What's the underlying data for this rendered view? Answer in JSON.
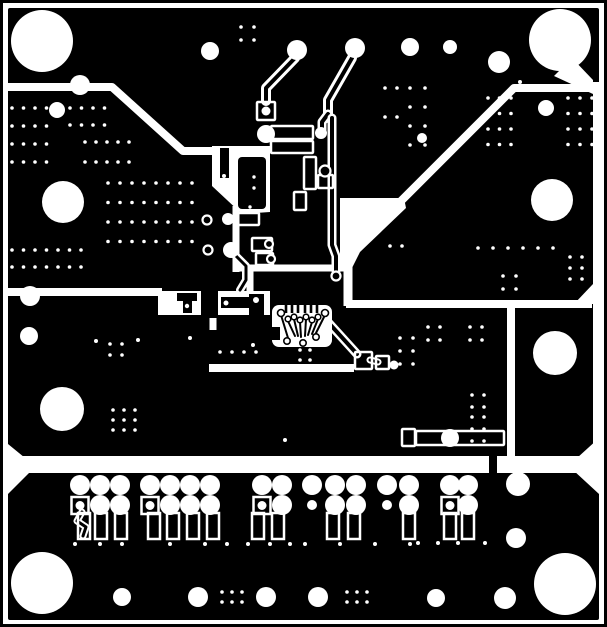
{
  "meta": {
    "title": "PCB copper layer artwork (negative, black = copper)",
    "width": 607,
    "height": 627,
    "colors": {
      "copper": "#000000",
      "clearance": "#ffffff"
    }
  },
  "pcb": {
    "board": [
      8,
      8,
      591,
      612
    ],
    "frame": {
      "inset": 1.5,
      "stroke": 3
    },
    "wpolys": [
      [
        [
          212,
          146
        ],
        [
          270,
          146
        ],
        [
          270,
          212
        ],
        [
          242,
          214
        ],
        [
          212,
          186
        ]
      ],
      [
        [
          340,
          198
        ],
        [
          404,
          198
        ],
        [
          406,
          208
        ],
        [
          360,
          252
        ],
        [
          352,
          268
        ],
        [
          340,
          268
        ]
      ],
      [
        [
          572,
          58
        ],
        [
          593,
          80
        ],
        [
          593,
          94
        ],
        [
          554,
          76
        ]
      ],
      [
        [
          8,
          444
        ],
        [
          30,
          462
        ],
        [
          8,
          462
        ]
      ],
      [
        [
          8,
          470
        ],
        [
          32,
          470
        ],
        [
          8,
          494
        ]
      ],
      [
        [
          599,
          470
        ],
        [
          573,
          470
        ],
        [
          599,
          494
        ]
      ],
      [
        [
          599,
          438
        ],
        [
          599,
          458
        ],
        [
          577,
          458
        ]
      ],
      [
        [
          593,
          284
        ],
        [
          593,
          304
        ],
        [
          574,
          304
        ]
      ]
    ],
    "wrects": [
      [
        593,
        82,
        8,
        380
      ],
      [
        8,
        456,
        591,
        17
      ],
      [
        158,
        291,
        112,
        24
      ]
    ],
    "channels": [
      {
        "pts": [
          [
            8,
            87
          ],
          [
            112,
            87
          ],
          [
            183,
            151
          ],
          [
            216,
            151
          ]
        ],
        "w": 8
      },
      {
        "pts": [
          [
            599,
            88
          ],
          [
            514,
            88
          ],
          [
            398,
            204
          ]
        ],
        "w": 8
      },
      {
        "pts": [
          [
            233,
            268
          ],
          [
            344,
            268
          ]
        ],
        "w": 7
      },
      {
        "pts": [
          [
            236,
            206
          ],
          [
            236,
            272
          ]
        ],
        "w": 7
      },
      {
        "pts": [
          [
            250,
            268
          ],
          [
            250,
            294
          ]
        ],
        "w": 7
      },
      {
        "pts": [
          [
            346,
            304
          ],
          [
            592,
            304
          ]
        ],
        "w": 8
      },
      {
        "pts": [
          [
            511,
            304
          ],
          [
            511,
            460
          ]
        ],
        "w": 8
      },
      {
        "pts": [
          [
            8,
            292
          ],
          [
            162,
            292
          ]
        ],
        "w": 8
      },
      {
        "pts": [
          [
            213,
            294
          ],
          [
            213,
            330
          ]
        ],
        "w": 7
      },
      {
        "pts": [
          [
            209,
            368
          ],
          [
            354,
            368
          ]
        ],
        "w": 8
      },
      {
        "pts": [
          [
            348,
            240
          ],
          [
            348,
            306
          ]
        ],
        "w": 9
      }
    ],
    "bislands": [
      [
        201,
        289,
        17,
        29
      ],
      [
        177,
        293,
        20,
        8
      ],
      [
        183,
        300,
        9,
        13
      ],
      [
        221,
        297,
        28,
        11
      ],
      [
        249,
        294,
        15,
        22
      ],
      [
        220,
        148,
        9,
        30
      ],
      [
        489,
        455,
        8,
        19
      ]
    ],
    "traces": [
      {
        "pts": [
          [
            295,
            58
          ],
          [
            266,
            88
          ],
          [
            266,
            101
          ]
        ],
        "out": 10,
        "core": 4
      },
      {
        "pts": [
          [
            352,
            58
          ],
          [
            328,
            100
          ],
          [
            328,
            118
          ]
        ],
        "out": 10,
        "core": 4
      },
      {
        "pts": [
          [
            328,
            114
          ],
          [
            322,
            122
          ],
          [
            322,
            130
          ]
        ],
        "out": 9,
        "core": 4
      },
      {
        "pts": [
          [
            332,
            118
          ],
          [
            332,
            245
          ],
          [
            336,
            256
          ],
          [
            336,
            271
          ]
        ],
        "out": 9,
        "core": 4
      },
      {
        "pts": [
          [
            234,
            254
          ],
          [
            246,
            266
          ],
          [
            246,
            280
          ],
          [
            240,
            290
          ]
        ],
        "out": 8,
        "core": 3
      },
      {
        "pts": [
          [
            327,
            321
          ],
          [
            357,
            354
          ]
        ],
        "out": 9,
        "core": 4
      },
      {
        "pts": [
          [
            370,
            360
          ],
          [
            378,
            362
          ]
        ],
        "out": 7,
        "core": 3
      },
      {
        "pts": [
          [
            82,
            512
          ],
          [
            77,
            521
          ],
          [
            86,
            527
          ],
          [
            83,
            536
          ]
        ],
        "out": 7,
        "core": 3
      }
    ],
    "boxes": [
      [
        257,
        102,
        18,
        18
      ],
      [
        271,
        126,
        42,
        13
      ],
      [
        271,
        141,
        42,
        12
      ],
      [
        237,
        213,
        22,
        12
      ],
      [
        252,
        238,
        20,
        13
      ],
      [
        256,
        253,
        17,
        12
      ],
      [
        416,
        431,
        88,
        14
      ],
      [
        402,
        429,
        13,
        17
      ],
      [
        355,
        352,
        17,
        17
      ],
      [
        376,
        356,
        13,
        13
      ],
      [
        318,
        175,
        15,
        13
      ],
      [
        304,
        157,
        12,
        32
      ],
      [
        294,
        192,
        12,
        18
      ]
    ],
    "rings": [
      [
        207,
        220,
        4.5
      ],
      [
        208,
        250,
        4.5
      ],
      [
        269,
        244,
        4
      ],
      [
        271,
        259,
        4
      ],
      [
        325,
        171,
        5.5
      ],
      [
        336,
        276,
        4.5
      ]
    ],
    "wdots": [
      [
        266,
        111,
        4.5
      ],
      [
        187,
        306,
        2.2
      ],
      [
        226,
        303,
        2.5
      ],
      [
        256,
        300,
        3
      ],
      [
        224,
        176,
        2
      ],
      [
        254,
        177,
        1.7
      ],
      [
        254,
        188,
        1.7
      ],
      [
        250,
        207,
        1.7
      ]
    ],
    "ic1_body": [
      238,
      157,
      28,
      52
    ],
    "ic2": {
      "blob": [
        272,
        305,
        60,
        42
      ],
      "square": [
        266,
        327,
        14,
        13
      ],
      "stub_xs": [
        286,
        292,
        298,
        305,
        311,
        317
      ],
      "rings_top": [
        [
          281,
          313,
          3.5
        ],
        [
          288,
          319,
          2.8
        ],
        [
          294,
          317,
          2.8
        ],
        [
          300,
          320,
          2.8
        ],
        [
          306,
          317,
          2.8
        ],
        [
          312,
          320,
          2.8
        ],
        [
          318,
          317,
          2.8
        ],
        [
          325,
          313,
          3.5
        ]
      ],
      "rings_bottom": [
        [
          287,
          341,
          3.2
        ],
        [
          303,
          343,
          3.2
        ],
        [
          316,
          337,
          3.2
        ]
      ],
      "fan": [
        [
          [
            281,
            315
          ],
          [
            288,
            338
          ]
        ],
        [
          [
            288,
            321
          ],
          [
            295,
            336
          ]
        ],
        [
          [
            294,
            319
          ],
          [
            298,
            336
          ]
        ],
        [
          [
            300,
            322
          ],
          [
            301,
            337
          ]
        ],
        [
          [
            306,
            319
          ],
          [
            305,
            336
          ]
        ],
        [
          [
            312,
            322
          ],
          [
            308,
            335
          ]
        ],
        [
          [
            318,
            319
          ],
          [
            312,
            334
          ]
        ],
        [
          [
            325,
            315
          ],
          [
            316,
            333
          ]
        ]
      ]
    },
    "big_holes": [
      [
        42,
        41,
        31
      ],
      [
        560,
        40,
        31
      ],
      [
        63,
        202,
        21
      ],
      [
        552,
        200,
        21
      ],
      [
        62,
        409,
        22
      ],
      [
        555,
        353,
        22
      ],
      [
        42,
        583,
        31
      ],
      [
        565,
        584,
        31
      ]
    ],
    "pads_round": [
      [
        80,
        85,
        10
      ],
      [
        57,
        110,
        8
      ],
      [
        210,
        51,
        9
      ],
      [
        297,
        50,
        10
      ],
      [
        355,
        48,
        10
      ],
      [
        410,
        47,
        9
      ],
      [
        450,
        47,
        7
      ],
      [
        499,
        62,
        11
      ],
      [
        546,
        108,
        8
      ],
      [
        422,
        138,
        5
      ],
      [
        266,
        134,
        9
      ],
      [
        231,
        250,
        8
      ],
      [
        30,
        296,
        10
      ],
      [
        29,
        336,
        9
      ],
      [
        450,
        438,
        9
      ],
      [
        321,
        133,
        6
      ],
      [
        228,
        219,
        6
      ],
      [
        394,
        365,
        4.5
      ],
      [
        518,
        484,
        12
      ],
      [
        516,
        538,
        10
      ],
      [
        122,
        597,
        9
      ],
      [
        198,
        597,
        10
      ],
      [
        266,
        597,
        10
      ],
      [
        318,
        597,
        10
      ],
      [
        436,
        598,
        9
      ],
      [
        505,
        598,
        11
      ]
    ],
    "via_clusters": [
      [
        12,
        108,
        4,
        4,
        11.5,
        18
      ],
      [
        70,
        108,
        4,
        2,
        11.5,
        17
      ],
      [
        85,
        142,
        5,
        2,
        11,
        20
      ],
      [
        108,
        183,
        8,
        4,
        12,
        19.5
      ],
      [
        12,
        250,
        7,
        2,
        11.5,
        17
      ],
      [
        241,
        27,
        2,
        2,
        13,
        13
      ],
      [
        385,
        88,
        2,
        2,
        12,
        29
      ],
      [
        410,
        88,
        2,
        4,
        15,
        19
      ],
      [
        488,
        98,
        3,
        4,
        11.5,
        15.5
      ],
      [
        568,
        98,
        3,
        4,
        12,
        15.5
      ],
      [
        478,
        248,
        6,
        1,
        15,
        1
      ],
      [
        570,
        257,
        2,
        3,
        12,
        11
      ],
      [
        503,
        276,
        2,
        2,
        13,
        13
      ],
      [
        428,
        327,
        2,
        2,
        12,
        13
      ],
      [
        470,
        327,
        2,
        2,
        12,
        13
      ],
      [
        400,
        338,
        2,
        3,
        13,
        13
      ],
      [
        472,
        395,
        2,
        2,
        12,
        12
      ],
      [
        472,
        417,
        2,
        3,
        12,
        12
      ],
      [
        110,
        344,
        2,
        2,
        12,
        11
      ],
      [
        113,
        410,
        3,
        3,
        11,
        10
      ],
      [
        220,
        352,
        4,
        1,
        12,
        1
      ],
      [
        270,
        333,
        2,
        1,
        13,
        1
      ],
      [
        390,
        246,
        2,
        1,
        12,
        1
      ],
      [
        300,
        350,
        2,
        2,
        10,
        10
      ],
      [
        222,
        592,
        3,
        2,
        10,
        10
      ],
      [
        347,
        592,
        3,
        2,
        10,
        10
      ]
    ],
    "via_singles": [
      [
        96,
        341
      ],
      [
        138,
        340
      ],
      [
        190,
        338
      ],
      [
        253,
        345
      ],
      [
        285,
        440
      ],
      [
        520,
        82
      ],
      [
        75,
        544
      ],
      [
        100,
        544
      ],
      [
        122,
        544
      ],
      [
        170,
        544
      ],
      [
        205,
        544
      ],
      [
        227,
        544
      ],
      [
        248,
        544
      ],
      [
        270,
        544
      ],
      [
        290,
        544
      ],
      [
        305,
        544
      ],
      [
        340,
        544
      ],
      [
        375,
        544
      ],
      [
        410,
        544
      ],
      [
        418,
        543
      ],
      [
        438,
        543
      ],
      [
        458,
        543
      ],
      [
        485,
        543
      ]
    ],
    "connector": {
      "row1_y": 485,
      "row2_y": 505,
      "pad_r": 10,
      "small_r": 5,
      "square": {
        "size": 17,
        "y": 497,
        "hole_r": 4.5
      },
      "pin": {
        "y": 513,
        "w": 12,
        "h": 26,
        "stroke": 2.5
      },
      "groups": [
        {
          "cols": [
            80,
            100,
            120
          ],
          "square_col": 80,
          "small_cols": [],
          "pins": [
            84,
            101,
            121
          ]
        },
        {
          "cols": [
            150,
            170,
            190,
            210
          ],
          "square_col": 150,
          "small_cols": [],
          "pins": [
            154,
            173,
            193,
            213
          ]
        },
        {
          "cols": [
            262,
            282
          ],
          "square_col": 262,
          "small_cols": [],
          "pins": [
            258,
            278
          ]
        },
        {
          "cols": [
            312,
            335,
            356
          ],
          "square_col": null,
          "small_cols": [
            312
          ],
          "pins": [
            333,
            354
          ]
        },
        {
          "cols": [
            387,
            409
          ],
          "square_col": null,
          "small_cols": [
            387
          ],
          "pins": [
            409
          ]
        },
        {
          "cols": [
            450,
            468
          ],
          "square_col": 450,
          "small_cols": [],
          "pins": [
            450,
            468
          ]
        }
      ]
    }
  }
}
